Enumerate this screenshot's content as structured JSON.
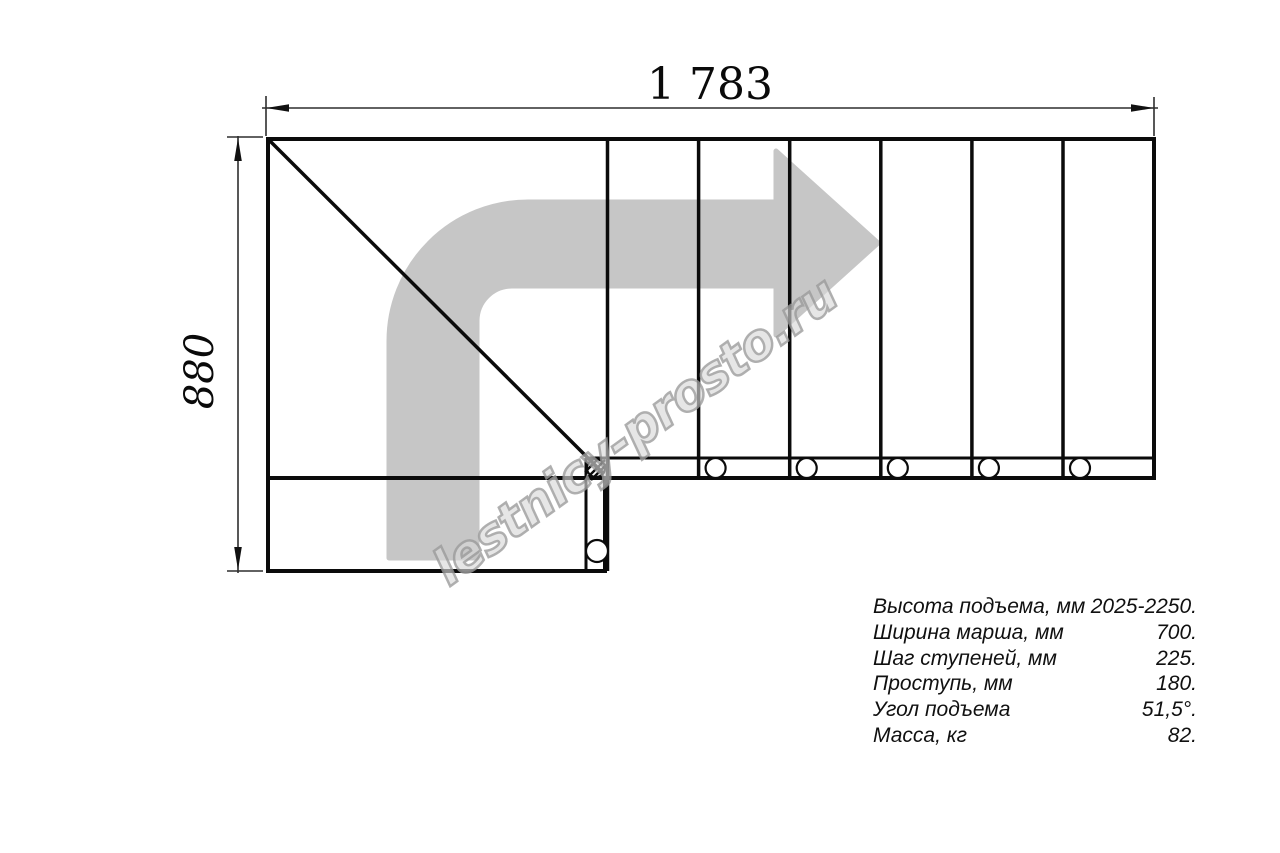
{
  "page": {
    "background": "#ffffff",
    "description": "Staircase plan drawing (top view) with dimensions and specification table"
  },
  "drawing": {
    "top_dimension_label": "1 783",
    "left_dimension_label": "880",
    "line_color": "#0b0b0b",
    "arrow_color": "#c6c6c6",
    "step_count_right_flight": 6,
    "bolt_circle_count": 7
  },
  "watermark": {
    "text": "lestnicy-prosto.ru"
  },
  "specs": {
    "rows": [
      {
        "label": "Высота подъема, мм",
        "value": "2025-2250."
      },
      {
        "label": "Ширина марша, мм",
        "value": "700."
      },
      {
        "label": "Шаг ступеней, мм",
        "value": "225."
      },
      {
        "label": "Проступь, мм",
        "value": "180."
      },
      {
        "label": "Угол подъема",
        "value": "51,5°."
      },
      {
        "label": "Масса, кг",
        "value": "82."
      }
    ]
  }
}
